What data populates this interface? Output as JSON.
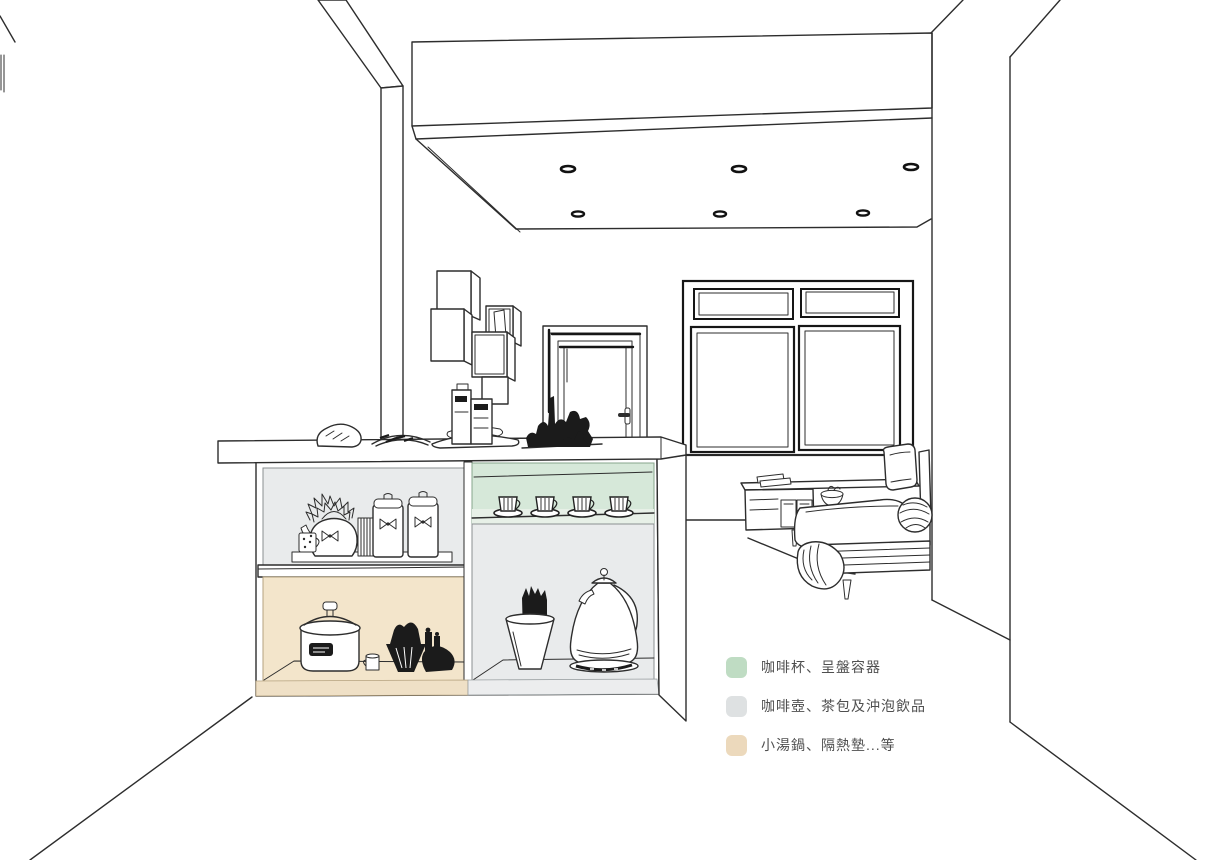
{
  "scene": {
    "description": "Interior perspective line drawing of a kitchen island coffee bar with color-coded storage zones, door, window, ceiling spotlights and living-room sofa",
    "zones": [
      {
        "name": "cup-shelf",
        "color": "#d6e8d9"
      },
      {
        "name": "kettle-and-tea-compartment",
        "color": "#e9ebec"
      },
      {
        "name": "soup-pot-compartment",
        "color": "#f3e5cb"
      }
    ]
  },
  "palette": {
    "line": "#2d2d2d",
    "shelf_green": "#d6e8d9",
    "board_green": "#e7f0e7",
    "shelf_gray": "#e9ebec",
    "shelf_tan": "#f3e5cb",
    "kick_tan": "#efe0c6",
    "kick_gray": "#ecedee"
  },
  "legend": {
    "items": [
      {
        "id": "cups",
        "color": "#bfdcc3",
        "label": "咖啡杯、呈盤容器"
      },
      {
        "id": "pots",
        "color": "#dee1e2",
        "label": "咖啡壺、茶包及沖泡飲品"
      },
      {
        "id": "soup",
        "color": "#ecd9bc",
        "label": "小湯鍋、隔熱墊...等"
      }
    ]
  }
}
